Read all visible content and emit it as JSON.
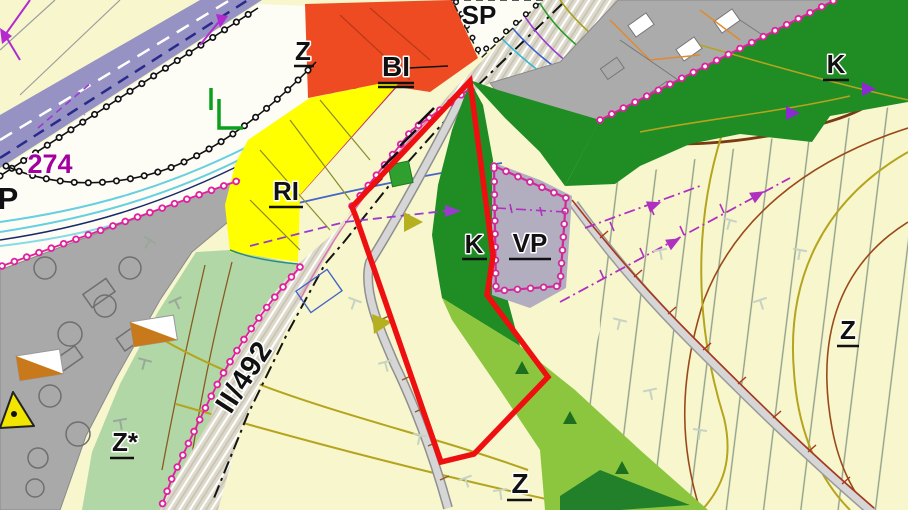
{
  "map": {
    "labels": {
      "sp": "SP",
      "z_top": "Z",
      "bi": "BI",
      "num_274": "274",
      "p": "P",
      "ri": "RI",
      "k_center": "K",
      "vp": "VP",
      "k_right": "K",
      "z_right": "Z",
      "z_star": "Z*",
      "z_bottom": "Z",
      "road_ii492": "II/492"
    },
    "colors": {
      "zone_bi_orange": "#ee4b23",
      "zone_ri_yellow": "#ffff00",
      "zone_k_dark_green": "#1f8c24",
      "zone_k_light_green": "#8cc63e",
      "zone_z_cream": "#f7f6cd",
      "zone_z_star_pale_green": "#b2d7a6",
      "zone_gray": "#ababab",
      "zone_vp_gray": "#b3adc0",
      "road_band_purple": "#9692c4",
      "stream_cyan": "#66cfe2",
      "highlight_outline_red": "#ee1010",
      "boundary_magenta": "#e020a0",
      "contour_brown": "#9a4a1a",
      "contour_olive": "#b5a41e",
      "label_274_magenta": "#a4009e"
    }
  }
}
